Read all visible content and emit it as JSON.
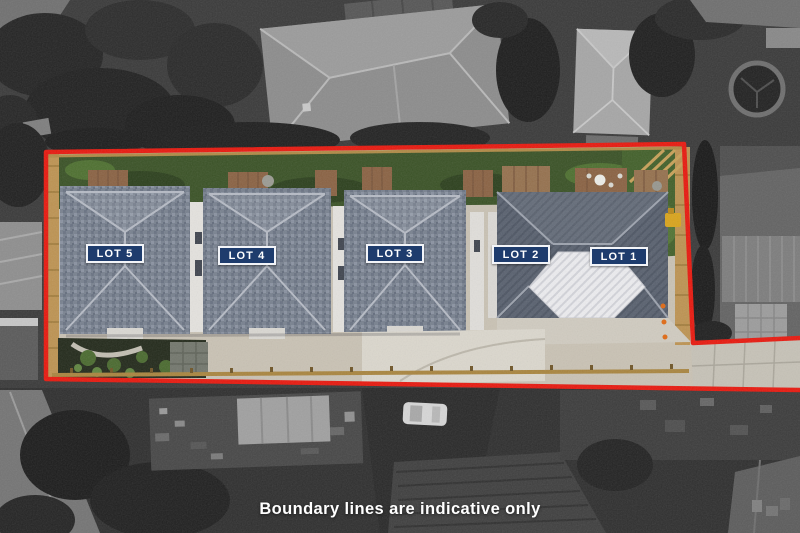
{
  "site_plan": {
    "caption": "Boundary lines are indicative only",
    "lots": [
      {
        "number": 1,
        "label": "LOT 1"
      },
      {
        "number": 2,
        "label": "LOT 2"
      },
      {
        "number": 3,
        "label": "LOT 3"
      },
      {
        "number": 4,
        "label": "LOT 4"
      },
      {
        "number": 5,
        "label": "LOT 5"
      }
    ],
    "colors": {
      "boundary_line": "#e8190f",
      "label_background": "#1e3c6d",
      "label_border": "#f2f4f8",
      "label_text": "#ffffff",
      "caption_text": "#ffffff"
    }
  }
}
